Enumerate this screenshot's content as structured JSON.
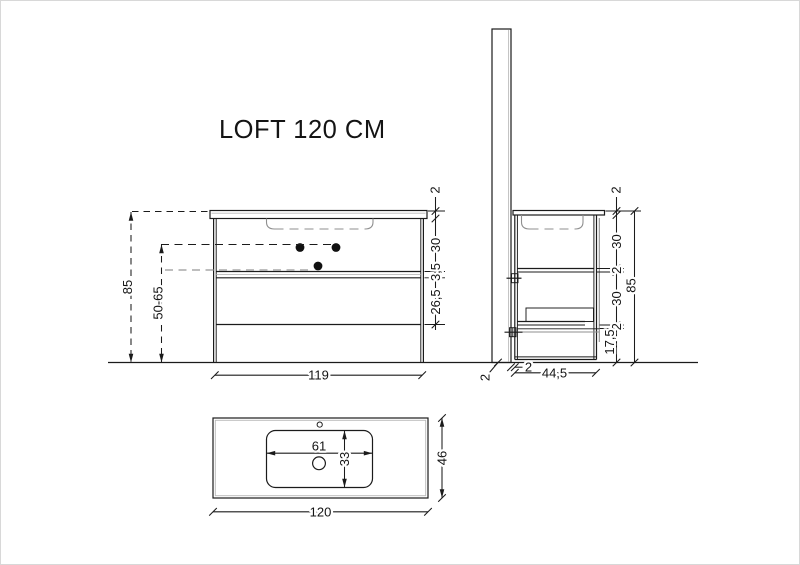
{
  "drawing": {
    "title": "LOFT 120 CM",
    "front_view": {
      "total_height": "85",
      "drain_height_range": "50-65",
      "cabinet_width": "119",
      "chain": [
        "2",
        "30",
        "3,5",
        "26,5"
      ]
    },
    "side_view": {
      "chain": [
        "2",
        "30",
        "2",
        "30",
        "2",
        "17,5"
      ],
      "total_height": "85",
      "panel_thickness": "2",
      "wall_gap": "2",
      "cabinet_depth": "44,5"
    },
    "top_view": {
      "basin_width": "61",
      "basin_depth": "33",
      "counter_depth": "46",
      "counter_width": "120"
    },
    "colors": {
      "line": "#1b1b1b",
      "secondary_line": "#8f8f8f",
      "light_dashed": "#a9a9a9",
      "background": "#ffffff"
    }
  }
}
